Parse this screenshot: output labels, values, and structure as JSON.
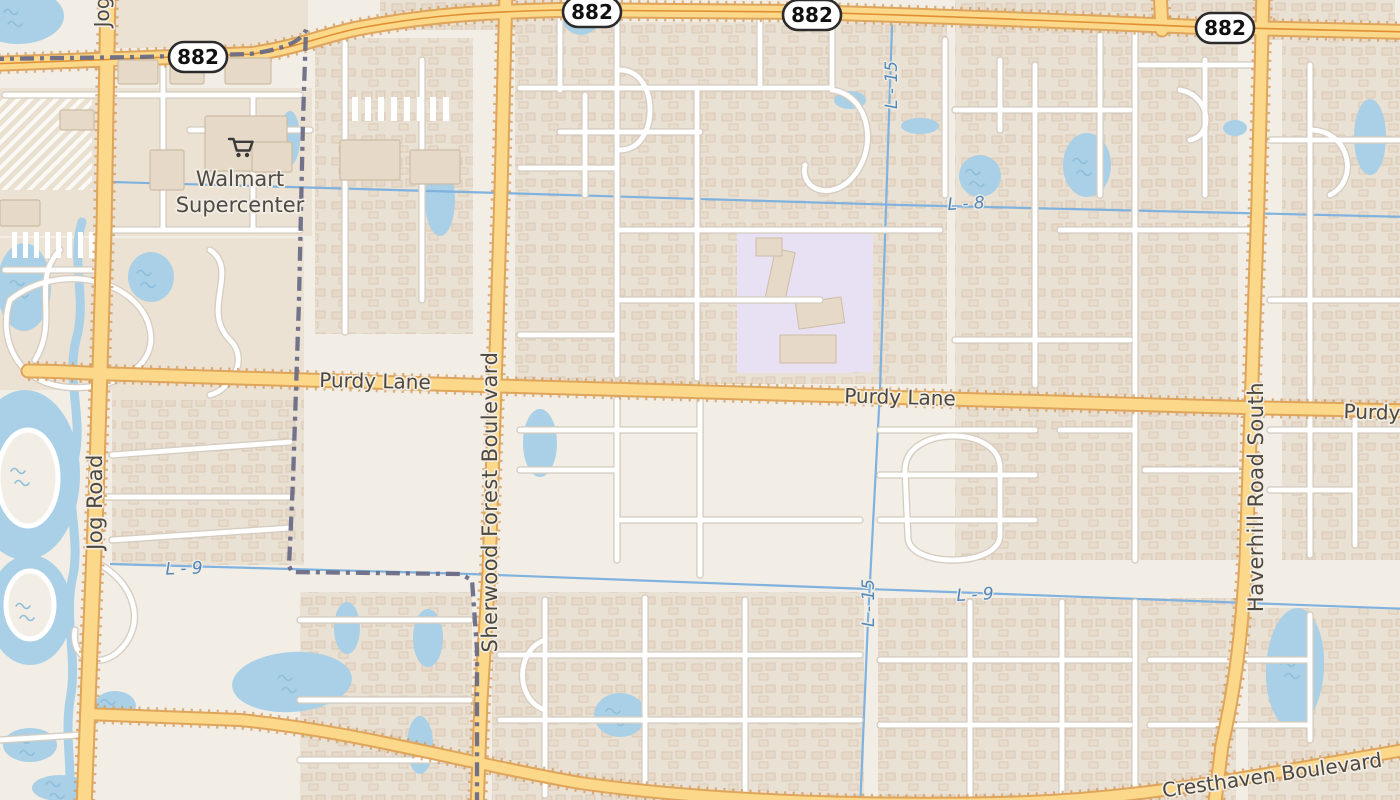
{
  "shields": [
    {
      "label": "882"
    },
    {
      "label": "882"
    },
    {
      "label": "882"
    },
    {
      "label": "882"
    }
  ],
  "road_labels": {
    "purdy_west": "Purdy Lane",
    "purdy_mid": "Purdy Lane",
    "purdy_east": "Purdy",
    "jog_top": "Jog",
    "jog": "Jog Road",
    "sherwood": "Sherwood Forest Boulevard",
    "haverhill": "Haverhill Road South",
    "cresthaven": "Cresthaven Boulevard"
  },
  "water_labels": {
    "l8": "L - 8",
    "l9_left": "L - 9",
    "l9_right": "L - 9",
    "l15_top": "L - 15",
    "l15_bottom": "L - 15"
  },
  "poi": {
    "walmart_line1": "Walmart",
    "walmart_line2": "Supercenter",
    "walmart_icon": "shopping-cart-icon"
  },
  "colors": {
    "land": "#f2eee5",
    "residential": "#eae1d5",
    "commercial": "#ece2d4",
    "school": "#e7e1f3",
    "water": "#a9d0e6",
    "wave": "#8fbedb",
    "canal": "#7fb2df",
    "road_minor_fill": "#ffffff",
    "road_minor_casing": "#d5cdc1",
    "road_major_fill": "#fbd88a",
    "road_major_casing": "#dfa55b",
    "road_major_dots": "#d29a5c",
    "road_primary_line": "#e08f33",
    "boundary": "#6c6c86",
    "building_fill": "#e6d9c7",
    "building_stroke": "#cdbda6",
    "road_label": "#4d473e",
    "water_label": "#4f86bb",
    "poi_label": "#4e4a44",
    "shield_border": "#2b2b2b"
  }
}
